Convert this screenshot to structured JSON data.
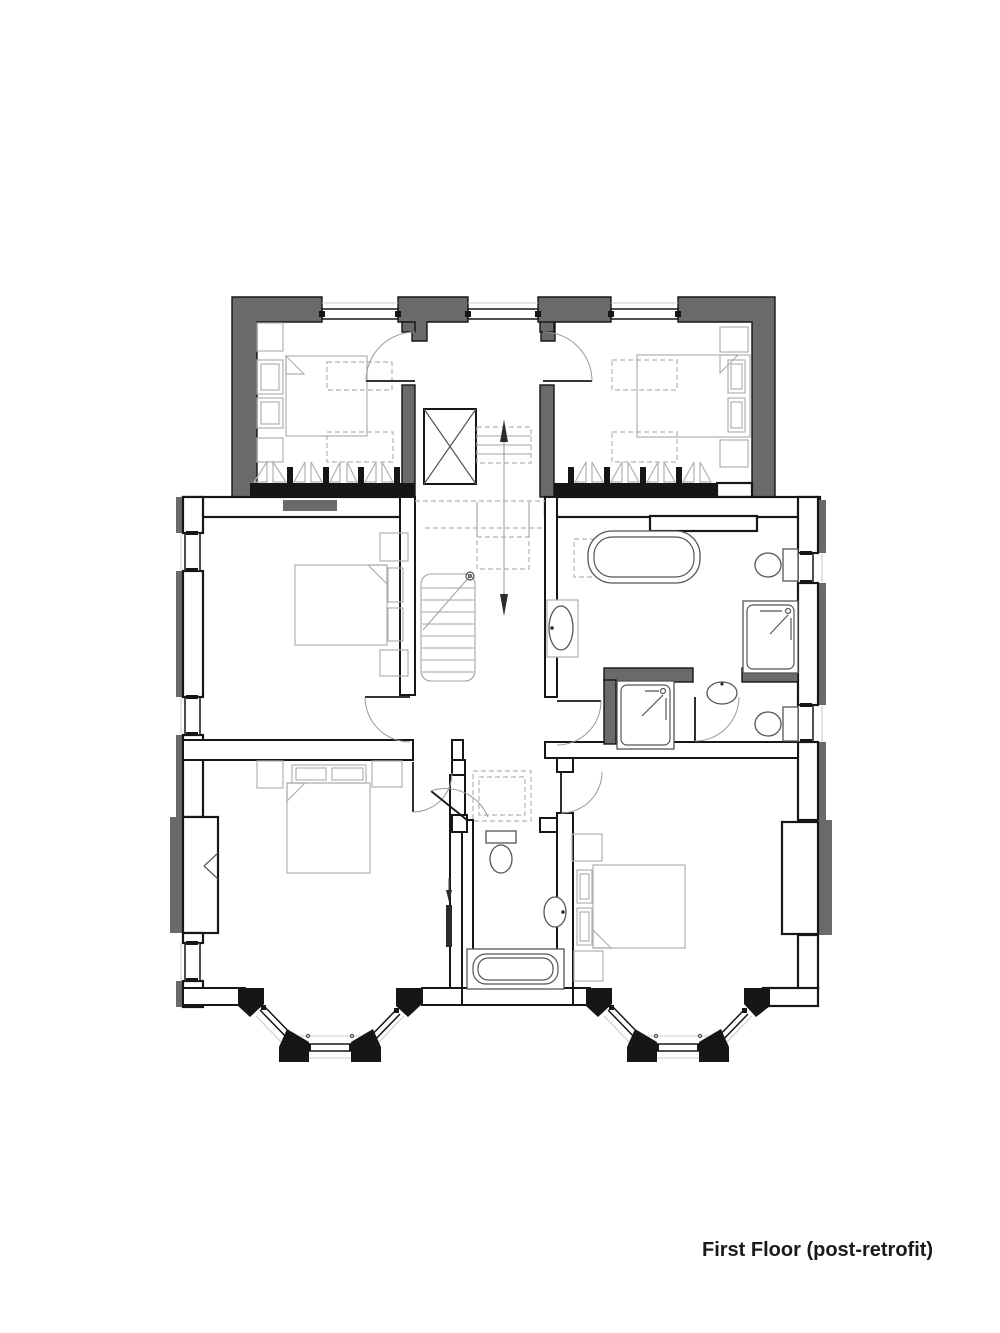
{
  "title": "First Floor (post-retrofit)",
  "colors": {
    "background": "#ffffff",
    "wall_outline": "#161616",
    "insulation_fill": "#6a6a6a",
    "furniture_line": "#b0b0b0",
    "fixture_line": "#555555",
    "dashed_line": "#b5b5b5",
    "stair_line": "#a3a3a3",
    "text": "#1a1a1a"
  }
}
